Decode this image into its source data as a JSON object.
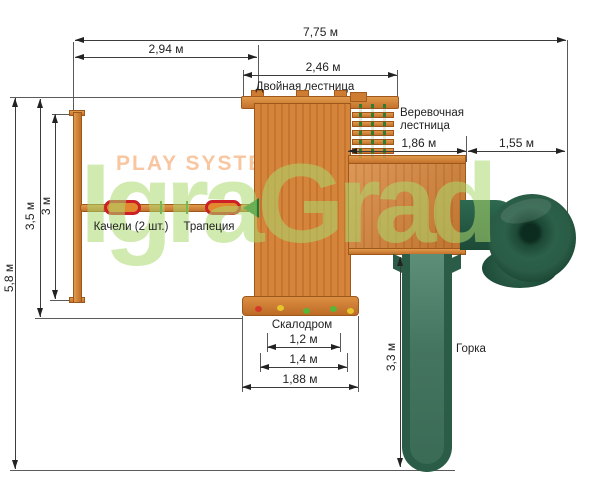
{
  "watermark": {
    "play_system": "PLAY SYSTEM",
    "brand": "IgraGrad"
  },
  "labels": {
    "double_ladder": "Двойная лестница",
    "rope_ladder_line1": "Веревочная",
    "rope_ladder_line2": "лестница",
    "swings": "Качели (2 шт.)",
    "trapeze": "Трапеция",
    "climbing_wall": "Скалодром",
    "slide": "Горка"
  },
  "dims": {
    "total_width": "7,75 м",
    "swings_to_platform": "2,94 м",
    "double_ladder_span": "2,46 м",
    "tower_width": "1,86 м",
    "spiral_slide_width": "1,55 м",
    "total_depth": "5,8 м",
    "swing_area_depth": "3,5 м",
    "swing_beam_length": "3 м",
    "slide_length": "3,3 м",
    "climbing_wall_inner": "1,2 м",
    "climbing_wall_mid": "1,4 м",
    "climbing_wall_outer": "1,88 м"
  },
  "colors": {
    "wood": "#d5843c",
    "wood_dark": "#9e571b",
    "slide_green": "#2a5c47",
    "rope_green": "#2e7d32",
    "seat_red": "#cc2026",
    "seat_fill": "#e2882f",
    "watermark_green": "#abd86e",
    "watermark_orange": "#f8c6a0",
    "dim_line": "#3c3c3c"
  }
}
